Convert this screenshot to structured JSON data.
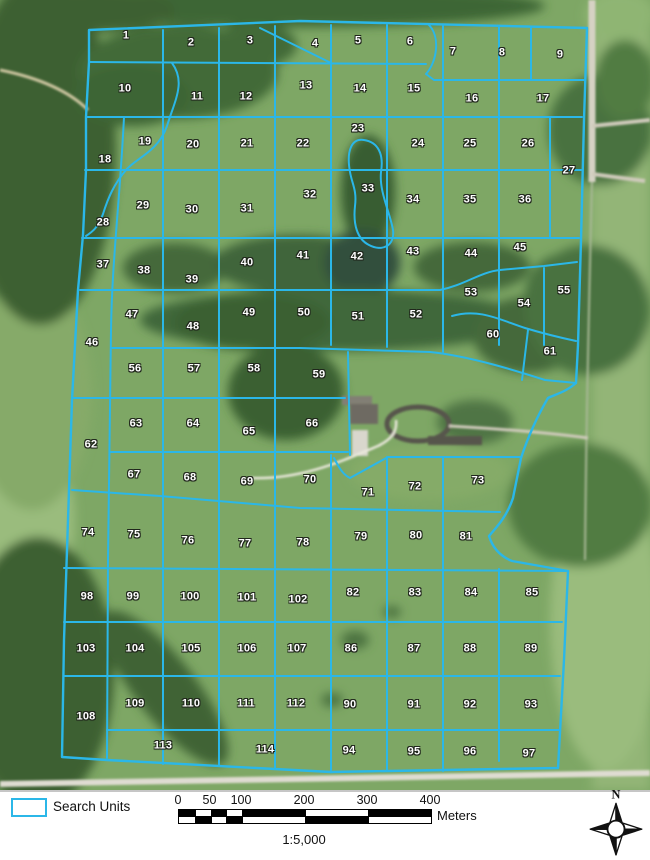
{
  "map": {
    "units": [
      {
        "n": "1",
        "x": 126,
        "y": 36
      },
      {
        "n": "2",
        "x": 191,
        "y": 43
      },
      {
        "n": "3",
        "x": 250,
        "y": 41
      },
      {
        "n": "4",
        "x": 315,
        "y": 44
      },
      {
        "n": "5",
        "x": 358,
        "y": 41
      },
      {
        "n": "6",
        "x": 410,
        "y": 42
      },
      {
        "n": "7",
        "x": 453,
        "y": 52
      },
      {
        "n": "8",
        "x": 502,
        "y": 53
      },
      {
        "n": "9",
        "x": 560,
        "y": 55
      },
      {
        "n": "10",
        "x": 125,
        "y": 89
      },
      {
        "n": "11",
        "x": 197,
        "y": 97
      },
      {
        "n": "12",
        "x": 246,
        "y": 97
      },
      {
        "n": "13",
        "x": 306,
        "y": 86
      },
      {
        "n": "14",
        "x": 360,
        "y": 89
      },
      {
        "n": "15",
        "x": 414,
        "y": 89
      },
      {
        "n": "16",
        "x": 472,
        "y": 99
      },
      {
        "n": "17",
        "x": 543,
        "y": 99
      },
      {
        "n": "18",
        "x": 105,
        "y": 160
      },
      {
        "n": "19",
        "x": 145,
        "y": 142
      },
      {
        "n": "20",
        "x": 193,
        "y": 145
      },
      {
        "n": "21",
        "x": 247,
        "y": 144
      },
      {
        "n": "22",
        "x": 303,
        "y": 144
      },
      {
        "n": "23",
        "x": 358,
        "y": 129
      },
      {
        "n": "24",
        "x": 418,
        "y": 144
      },
      {
        "n": "25",
        "x": 470,
        "y": 144
      },
      {
        "n": "26",
        "x": 528,
        "y": 144
      },
      {
        "n": "27",
        "x": 569,
        "y": 171
      },
      {
        "n": "28",
        "x": 103,
        "y": 223
      },
      {
        "n": "29",
        "x": 143,
        "y": 206
      },
      {
        "n": "30",
        "x": 192,
        "y": 210
      },
      {
        "n": "31",
        "x": 247,
        "y": 209
      },
      {
        "n": "32",
        "x": 310,
        "y": 195
      },
      {
        "n": "33",
        "x": 368,
        "y": 189
      },
      {
        "n": "34",
        "x": 413,
        "y": 200
      },
      {
        "n": "35",
        "x": 470,
        "y": 200
      },
      {
        "n": "36",
        "x": 525,
        "y": 200
      },
      {
        "n": "37",
        "x": 103,
        "y": 265
      },
      {
        "n": "38",
        "x": 144,
        "y": 271
      },
      {
        "n": "39",
        "x": 192,
        "y": 280
      },
      {
        "n": "40",
        "x": 247,
        "y": 263
      },
      {
        "n": "41",
        "x": 303,
        "y": 256
      },
      {
        "n": "42",
        "x": 357,
        "y": 257
      },
      {
        "n": "43",
        "x": 413,
        "y": 252
      },
      {
        "n": "44",
        "x": 471,
        "y": 254
      },
      {
        "n": "45",
        "x": 520,
        "y": 248
      },
      {
        "n": "46",
        "x": 92,
        "y": 343
      },
      {
        "n": "47",
        "x": 132,
        "y": 315
      },
      {
        "n": "48",
        "x": 193,
        "y": 327
      },
      {
        "n": "49",
        "x": 249,
        "y": 313
      },
      {
        "n": "50",
        "x": 304,
        "y": 313
      },
      {
        "n": "51",
        "x": 358,
        "y": 317
      },
      {
        "n": "52",
        "x": 416,
        "y": 315
      },
      {
        "n": "53",
        "x": 471,
        "y": 293
      },
      {
        "n": "54",
        "x": 524,
        "y": 304
      },
      {
        "n": "55",
        "x": 564,
        "y": 291
      },
      {
        "n": "56",
        "x": 135,
        "y": 369
      },
      {
        "n": "57",
        "x": 194,
        "y": 369
      },
      {
        "n": "58",
        "x": 254,
        "y": 369
      },
      {
        "n": "59",
        "x": 319,
        "y": 375
      },
      {
        "n": "60",
        "x": 493,
        "y": 335
      },
      {
        "n": "61",
        "x": 550,
        "y": 352
      },
      {
        "n": "62",
        "x": 91,
        "y": 445
      },
      {
        "n": "63",
        "x": 136,
        "y": 424
      },
      {
        "n": "64",
        "x": 193,
        "y": 424
      },
      {
        "n": "65",
        "x": 249,
        "y": 432
      },
      {
        "n": "66",
        "x": 312,
        "y": 424
      },
      {
        "n": "67",
        "x": 134,
        "y": 475
      },
      {
        "n": "68",
        "x": 190,
        "y": 478
      },
      {
        "n": "69",
        "x": 247,
        "y": 482
      },
      {
        "n": "70",
        "x": 310,
        "y": 480
      },
      {
        "n": "71",
        "x": 368,
        "y": 493
      },
      {
        "n": "72",
        "x": 415,
        "y": 487
      },
      {
        "n": "73",
        "x": 478,
        "y": 481
      },
      {
        "n": "74",
        "x": 88,
        "y": 533
      },
      {
        "n": "75",
        "x": 134,
        "y": 535
      },
      {
        "n": "76",
        "x": 188,
        "y": 541
      },
      {
        "n": "77",
        "x": 245,
        "y": 544
      },
      {
        "n": "78",
        "x": 303,
        "y": 543
      },
      {
        "n": "79",
        "x": 361,
        "y": 537
      },
      {
        "n": "80",
        "x": 416,
        "y": 536
      },
      {
        "n": "81",
        "x": 466,
        "y": 537
      },
      {
        "n": "82",
        "x": 353,
        "y": 593
      },
      {
        "n": "83",
        "x": 415,
        "y": 593
      },
      {
        "n": "84",
        "x": 471,
        "y": 593
      },
      {
        "n": "85",
        "x": 532,
        "y": 593
      },
      {
        "n": "86",
        "x": 351,
        "y": 649
      },
      {
        "n": "87",
        "x": 414,
        "y": 649
      },
      {
        "n": "88",
        "x": 470,
        "y": 649
      },
      {
        "n": "89",
        "x": 531,
        "y": 649
      },
      {
        "n": "90",
        "x": 350,
        "y": 705
      },
      {
        "n": "91",
        "x": 414,
        "y": 705
      },
      {
        "n": "92",
        "x": 470,
        "y": 705
      },
      {
        "n": "93",
        "x": 531,
        "y": 705
      },
      {
        "n": "94",
        "x": 349,
        "y": 751
      },
      {
        "n": "95",
        "x": 414,
        "y": 752
      },
      {
        "n": "96",
        "x": 470,
        "y": 752
      },
      {
        "n": "97",
        "x": 529,
        "y": 754
      },
      {
        "n": "98",
        "x": 87,
        "y": 597
      },
      {
        "n": "99",
        "x": 133,
        "y": 597
      },
      {
        "n": "100",
        "x": 190,
        "y": 597
      },
      {
        "n": "101",
        "x": 247,
        "y": 598
      },
      {
        "n": "102",
        "x": 298,
        "y": 600
      },
      {
        "n": "103",
        "x": 86,
        "y": 649
      },
      {
        "n": "104",
        "x": 135,
        "y": 649
      },
      {
        "n": "105",
        "x": 191,
        "y": 649
      },
      {
        "n": "106",
        "x": 247,
        "y": 649
      },
      {
        "n": "107",
        "x": 297,
        "y": 649
      },
      {
        "n": "108",
        "x": 86,
        "y": 717
      },
      {
        "n": "109",
        "x": 135,
        "y": 704
      },
      {
        "n": "110",
        "x": 191,
        "y": 704
      },
      {
        "n": "111",
        "x": 246,
        "y": 704
      },
      {
        "n": "112",
        "x": 296,
        "y": 704
      },
      {
        "n": "113",
        "x": 163,
        "y": 746
      },
      {
        "n": "114",
        "x": 265,
        "y": 750
      }
    ]
  },
  "legend": {
    "search_units_label": "Search Units"
  },
  "scalebar": {
    "ticks": [
      {
        "label": "0",
        "f": 0
      },
      {
        "label": "50",
        "f": 0.125
      },
      {
        "label": "100",
        "f": 0.25
      },
      {
        "label": "200",
        "f": 0.5
      },
      {
        "label": "300",
        "f": 0.75
      },
      {
        "label": "400",
        "f": 1
      }
    ],
    "segments": [
      0,
      0.0625,
      0.125,
      0.1875,
      0.25,
      0.5,
      0.75,
      1
    ],
    "unit_label": "Meters",
    "ratio_text": "1:5,000"
  },
  "north_arrow": {
    "label": "N"
  },
  "colors": {
    "grid_outline": "#2bb7e8"
  }
}
